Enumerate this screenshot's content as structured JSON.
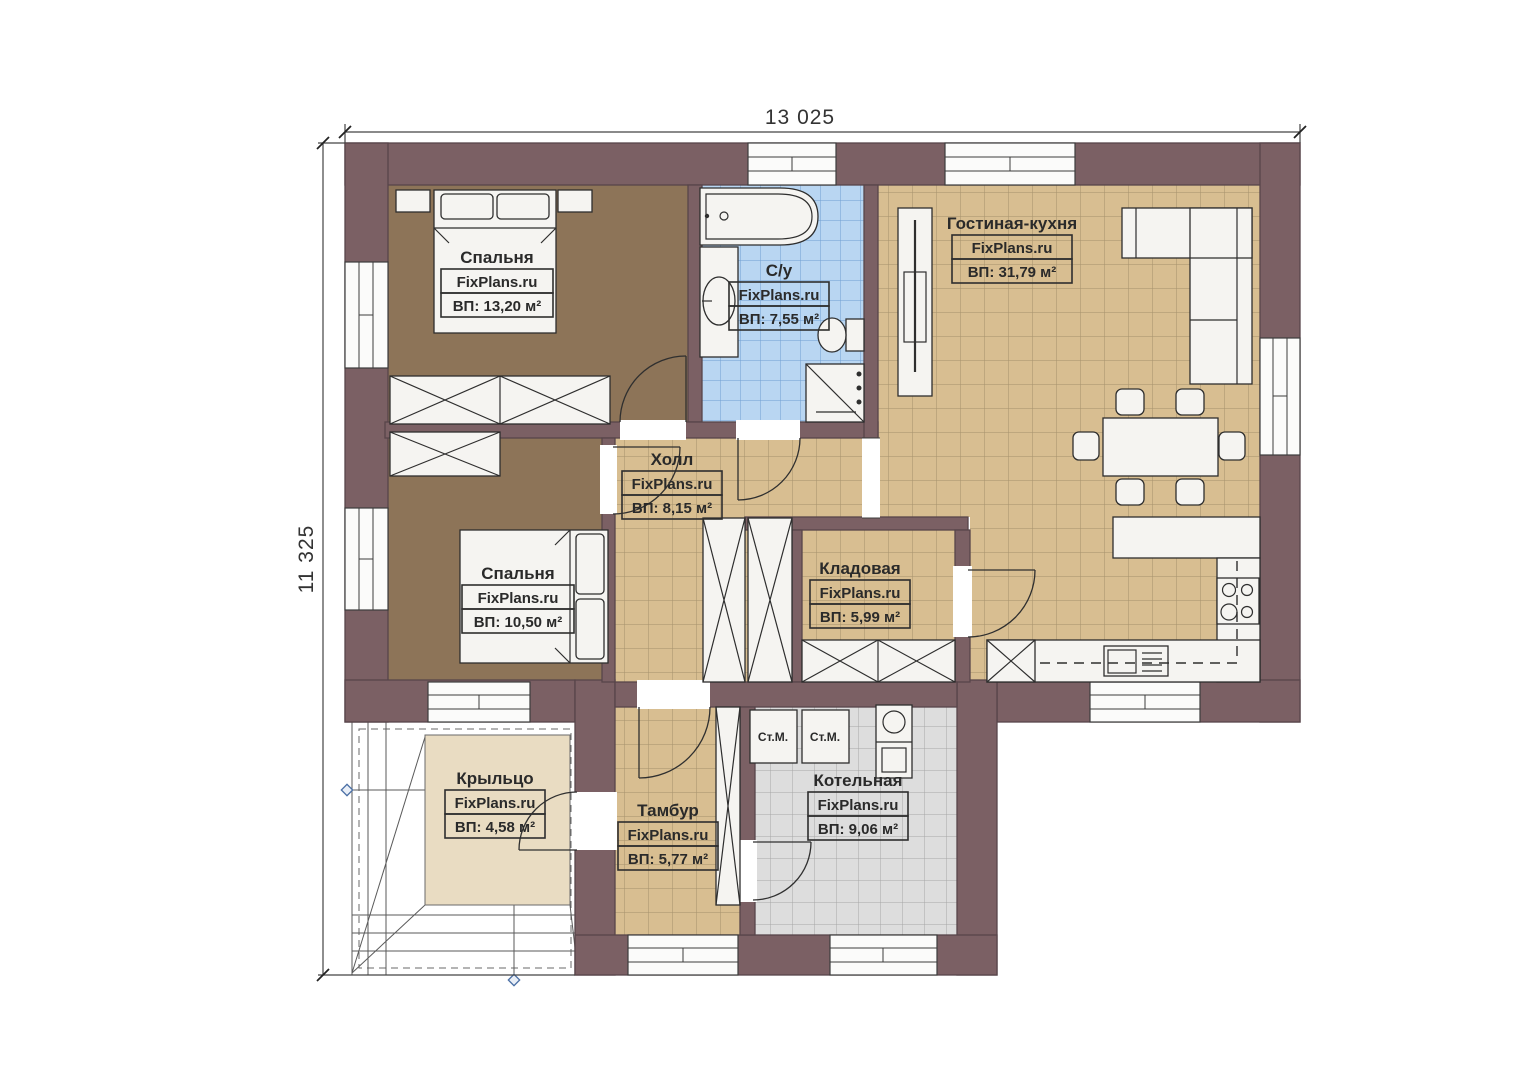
{
  "watermark": "FixPlans.ru",
  "dimensions": {
    "width": "13 025",
    "height": "11 325"
  },
  "rooms": [
    {
      "id": "bedroom-1",
      "name": "Спальня",
      "area": "ВП: 13,20 м²"
    },
    {
      "id": "bathroom",
      "name": "С/у",
      "area": "ВП: 7,55 м²"
    },
    {
      "id": "living-kitchen",
      "name": "Гостиная-кухня",
      "area": "ВП: 31,79 м²"
    },
    {
      "id": "hall",
      "name": "Холл",
      "area": "ВП: 8,15 м²"
    },
    {
      "id": "bedroom-2",
      "name": "Спальня",
      "area": "ВП: 10,50 м²"
    },
    {
      "id": "storage",
      "name": "Кладовая",
      "area": "ВП: 5,99 м²"
    },
    {
      "id": "porch",
      "name": "Крыльцо",
      "area": "ВП: 4,58 м²"
    },
    {
      "id": "vestibule",
      "name": "Тамбур",
      "area": "ВП: 5,77 м²"
    },
    {
      "id": "boiler-room",
      "name": "Котельная",
      "area": "ВП: 9,06 м²"
    }
  ],
  "labels": {
    "washing_machine": "Ст.М."
  },
  "colors": {
    "wall": "#7b6064",
    "wall_line": "#57454a",
    "wood": "#8d7458",
    "tan": "#d8be91",
    "tan_line": "#a5906c",
    "blue": "#b9d6f2",
    "blue_line": "#6f9fd2",
    "gray": "#dddddd",
    "gray_line": "#a6a6a6",
    "porch": "#e9dcc2",
    "accent": "#4a6fa5"
  }
}
